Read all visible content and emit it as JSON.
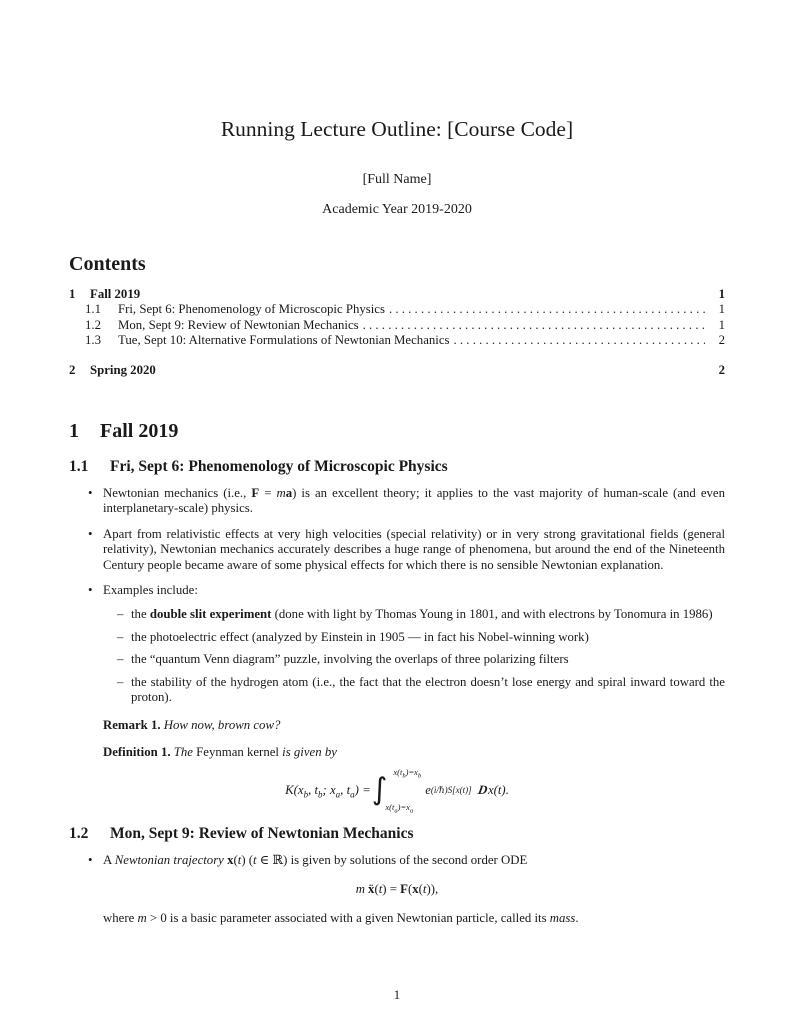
{
  "doc": {
    "title": "Running Lecture Outline: [Course Code]",
    "author": "[Full Name]",
    "date": "Academic Year 2019-2020",
    "page_number": "1"
  },
  "glyphs": {
    "bullet": "•",
    "dash": "–"
  },
  "toc": {
    "heading": "Contents",
    "rows": [
      {
        "num": "1",
        "label": "Fall 2019",
        "page": "1"
      },
      {
        "num": "1.1",
        "label": "Fri, Sept 6: Phenomenology of Microscopic Physics",
        "page": "1"
      },
      {
        "num": "1.2",
        "label": "Mon, Sept 9: Review of Newtonian Mechanics",
        "page": "1"
      },
      {
        "num": "1.3",
        "label": "Tue, Sept 10: Alternative Formulations of Newtonian Mechanics",
        "page": "2"
      },
      {
        "num": "2",
        "label": "Spring 2020",
        "page": "2"
      }
    ]
  },
  "s1": {
    "num": "1",
    "title": "Fall 2019"
  },
  "s11": {
    "num": "1.1",
    "title": "Fri, Sept 6: Phenomenology of Microscopic Physics",
    "b1": {
      "t1": "Newtonian mechanics (i.e., ",
      "F": "F",
      "t2": " = ",
      "m": "m",
      "a": "a",
      "t3": ") is an excellent theory; it applies to the vast majority of human-scale (and even interplanetary-scale) physics."
    },
    "b2": "Apart from relativistic effects at very high velocities (special relativity) or in very strong gravitational fields (general relativity), Newtonian mechanics accurately describes a huge range of phenomena, but around the end of the Nineteenth Century people became aware of some physical effects for which there is no sensible Newtonian explanation.",
    "b3": "Examples include:",
    "sub1": {
      "t1": "the ",
      "b": "double slit experiment",
      "t2": " (done with light by Thomas Young in 1801, and with electrons by Tonomura in 1986)"
    },
    "sub2": "the photoelectric effect (analyzed by Einstein in 1905 — in fact his Nobel-winning work)",
    "sub3": "the “quantum Venn diagram” puzzle, involving the overlaps of three polarizing filters",
    "sub4": "the stability of the hydrogen atom (i.e., the fact that the electron doesn’t lose energy and spiral inward toward the proton).",
    "remark": {
      "label": "Remark 1.",
      "text": "How now, brown cow?"
    },
    "definition": {
      "label": "Definition 1.",
      "i1": "The ",
      "r1": "Feynman kernel",
      "i2": " is given by"
    },
    "eq": {
      "lhs1": "K(x",
      "s1": "b",
      "lhs2": ", t",
      "s2": "b",
      "lhs3": "; x",
      "s3": "a",
      "lhs4": ", t",
      "s4": "a",
      "lhs5": ") =",
      "int": "∫",
      "up1": "x(t",
      "up2": "b",
      "up3": ")=x",
      "up4": "b",
      "lo1": "x(t",
      "lo2": "a",
      "lo3": ")=x",
      "lo4": "a",
      "e": "e",
      "exp": "(i/ℏ)S[x(t)]",
      "D": "D",
      "tail": "x(t)."
    }
  },
  "s12": {
    "num": "1.2",
    "title": "Mon, Sept 9: Review of Newtonian Mechanics",
    "b1": {
      "t1": "A ",
      "i1": "Newtonian trajectory",
      "t2": " ",
      "x": "x",
      "t3": "(",
      "tv": "t",
      "t4": ") (",
      "tv2": "t",
      "t5": " ∈ ℝ) is given by solutions of the second order ODE"
    },
    "eq": {
      "m": "m",
      "xdd": "ẍ",
      "t1": "(",
      "tv": "t",
      "t2": ") = ",
      "F": "F",
      "t3": "(",
      "x": "x",
      "t4": "(",
      "tv2": "t",
      "t5": ")),"
    },
    "after": {
      "t1": "where ",
      "m": "m",
      "t2": " > 0 is a basic parameter associated with a given Newtonian particle, called its ",
      "mass": "mass",
      "t3": "."
    }
  }
}
